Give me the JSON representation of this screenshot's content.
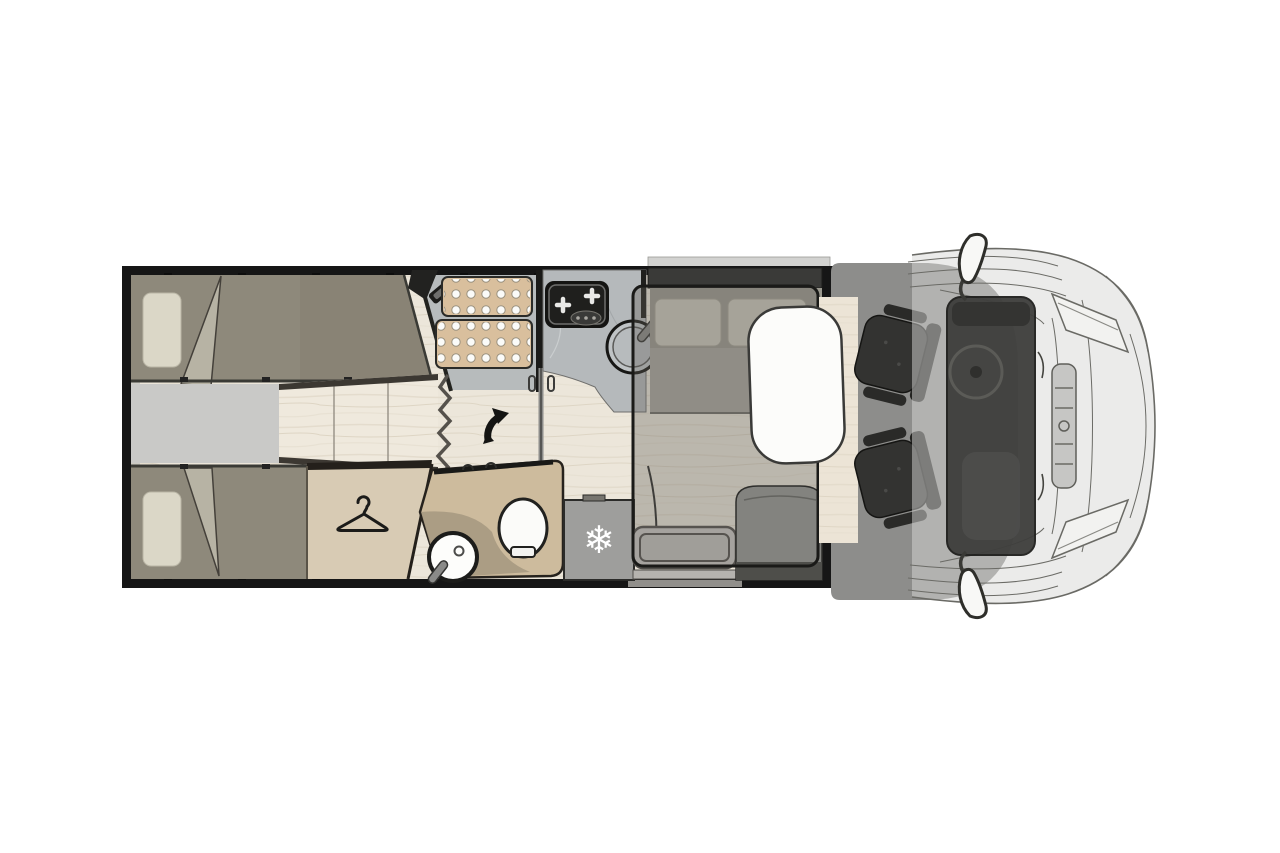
{
  "meta": {
    "scene": "motorhome-floorplan-top-view",
    "canvas_width": 1280,
    "canvas_height": 853
  },
  "icons": {
    "snowflake_glyph": "❄",
    "snowflake_name": "fridge-snowflake-icon",
    "hanger_name": "wardrobe-hanger-icon",
    "arrow_name": "door-swing-arrow-icon",
    "mirror_name": "wing-mirror-icon"
  },
  "zones": {
    "rear_bedroom": "twin-single-beds",
    "walkway": "center-walkway-steps",
    "wardrobe": "wardrobe",
    "shower": "shower-cabin",
    "kitchen": "kitchenette-hob-sink",
    "washroom": "washroom-toilet-basin",
    "fridge": "refrigerator",
    "entry": "entry-step",
    "dinette": "dinette-with-table",
    "drop_down_bed": "drop-down-bed-outline",
    "travel_seat": "belted-travel-seat",
    "cab": "driver-cab-swivel-seats",
    "vehicle": "van-front-end"
  },
  "colors": {
    "background": "#ffffff",
    "wall": "#161616",
    "floor_wood": "#ece6da",
    "walkway_gray": "#c9c9c7",
    "bed": "#8e897b",
    "bed_fold": "#b7b3a4",
    "pillow": "#dbd7c7",
    "wardrobe": "#d8cbb4",
    "shower_tray": "#d9bf9d",
    "shower_floor": "#b7bbbc",
    "counter": "#b5b9bb",
    "stove": "#141412",
    "washroom_pod": "#cdbb9d",
    "washroom_floor": "#a99b83",
    "fridge": "#9e9e9c",
    "step": "#c9c7c3",
    "bench_dark": "#3a3a38",
    "cushion": "#cbc8bc",
    "seat_fabric": "#83837f",
    "table": "#fcfcfa",
    "bed_overlay_border": "#1a1a18",
    "cab_floor": "#8d8d8b",
    "cab_seat": "#333331",
    "windshield": "#3e3e3c",
    "vehicle_body": "#d8d8d6",
    "white_fixture": "#fbfbf9"
  }
}
